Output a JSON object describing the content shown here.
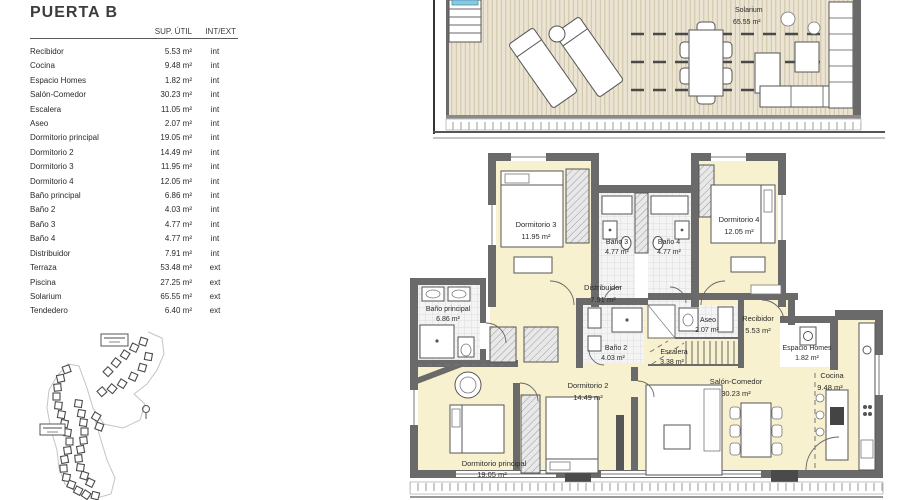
{
  "table": {
    "title": "PUERTA B",
    "header_area": "SUP. ÚTIL",
    "header_type": "INT/EXT",
    "rows": [
      {
        "name": "Recibidor",
        "area": "5.53 m²",
        "type": "int"
      },
      {
        "name": "Cocina",
        "area": "9.48 m²",
        "type": "int"
      },
      {
        "name": "Espacio Homes",
        "area": "1.82 m²",
        "type": "int"
      },
      {
        "name": "Salón-Comedor",
        "area": "30.23 m²",
        "type": "int"
      },
      {
        "name": "Escalera",
        "area": "11.05 m²",
        "type": "int"
      },
      {
        "name": "Aseo",
        "area": "2.07 m²",
        "type": "int"
      },
      {
        "name": "Dormitorio principal",
        "area": "19.05 m²",
        "type": "int"
      },
      {
        "name": "Dormitorio 2",
        "area": "14.49 m²",
        "type": "int"
      },
      {
        "name": "Dormitorio 3",
        "area": "11.95 m²",
        "type": "int"
      },
      {
        "name": "Dormitorio 4",
        "area": "12.05 m²",
        "type": "int"
      },
      {
        "name": "Baño principal",
        "area": "6.86 m²",
        "type": "int"
      },
      {
        "name": "Baño 2",
        "area": "4.03 m²",
        "type": "int"
      },
      {
        "name": "Baño 3",
        "area": "4.77 m²",
        "type": "int"
      },
      {
        "name": "Baño 4",
        "area": "4.77 m²",
        "type": "int"
      },
      {
        "name": "Distribuidor",
        "area": "7.91 m²",
        "type": "int"
      },
      {
        "name": "Terraza",
        "area": "53.48 m²",
        "type": "ext"
      },
      {
        "name": "Piscina",
        "area": "27.25 m²",
        "type": "ext"
      },
      {
        "name": "Solarium",
        "area": "65.55 m²",
        "type": "ext"
      },
      {
        "name": "Tendedero",
        "area": "6.40 m²",
        "type": "ext"
      }
    ]
  },
  "plan": {
    "solarium": {
      "label": "Solarium",
      "area": "65.55 m²"
    },
    "rooms": {
      "dorm3": {
        "label": "Dormitorio 3",
        "area": "11.95 m²"
      },
      "bano3": {
        "label": "Baño 3",
        "area": "4.77 m²"
      },
      "bano4": {
        "label": "Baño 4",
        "area": "4.77 m²"
      },
      "dorm4": {
        "label": "Dormitorio 4",
        "area": "12.05 m²"
      },
      "distribuidor": {
        "label": "Distribuidor",
        "area": "7.91 m²"
      },
      "bano_principal": {
        "label": "Baño principal",
        "area": "6.86 m²"
      },
      "bano2": {
        "label": "Baño 2",
        "area": "4.03 m²"
      },
      "escalera": {
        "label": "Escalera",
        "area": "3.38 m²"
      },
      "aseo": {
        "label": "Aseo",
        "area": "2.07 m²"
      },
      "recibidor": {
        "label": "Recibidor",
        "area": "5.53 m²"
      },
      "espacio_homes": {
        "label": "Espacio Homes",
        "area": "1.82 m²"
      },
      "cocina": {
        "label": "Cocina",
        "area": "9.48 m²"
      },
      "dorm2": {
        "label": "Dormitorio 2",
        "area": "14.49 m²"
      },
      "salon": {
        "label": "Salón-Comedor",
        "area": "30.23 m²"
      },
      "dorm_ppal": {
        "label": "Dormitorio principal",
        "area": "19.05 m²"
      }
    }
  },
  "colors": {
    "room_fill": "#f8f1cf",
    "wall": "#6a6a6a",
    "wall_dark": "#444444",
    "deck_bg": "#ebe4d2",
    "deck_stripe": "#cdc3a8",
    "tile_bg": "#f4f4f4",
    "tile_line": "#dcdcdc",
    "pool": "#85c9e2"
  }
}
